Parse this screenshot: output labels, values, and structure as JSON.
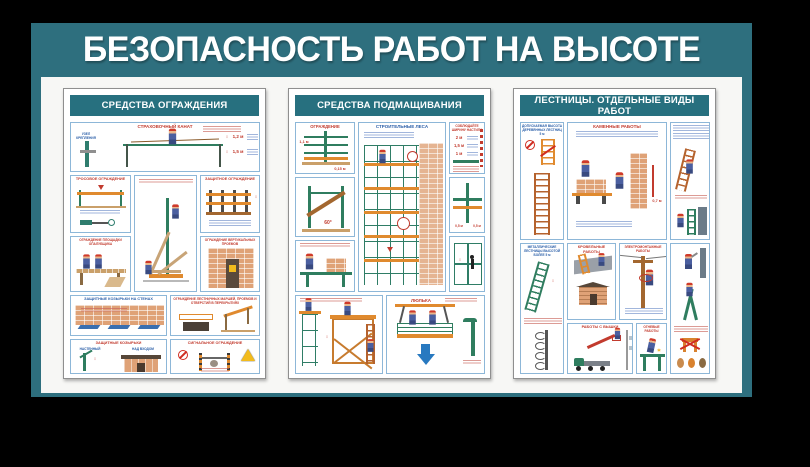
{
  "stand": {
    "title": "БЕЗОПАСНОСТЬ РАБОТ НА ВЫСОТЕ",
    "colors": {
      "background": "#000000",
      "stand_teal": "#2e6f7e",
      "header_teal": "#27707f",
      "board_bg": "#f7f7f5",
      "panel_border": "#8db7d8",
      "accent_red": "#c23b2e",
      "accent_blue": "#2b5fa8",
      "scaffold_green": "#2f7d5f",
      "deck_orange": "#e08a2e"
    }
  },
  "icons": {
    "v_arrow": "↕",
    "down_arrow": "▼",
    "spark": "✶"
  },
  "posters": [
    {
      "title": "СРЕДСТВА ОГРАЖДЕНИЯ",
      "panels": {
        "rope": {
          "title": "СТРАХОВОЧНЫЙ КАНАТ",
          "node": "УЗЕЛ КРЕПЛЕНИЯ",
          "dims": [
            "1,2 м",
            "1,5 м"
          ]
        },
        "cable": {
          "title": "ТРОСОВОЕ ОГРАЖДЕНИЕ"
        },
        "guard": {
          "title": "ЗАЩИТНОЕ ОГРАЖДЕНИЕ"
        },
        "platform": {
          "title": "ОГРАЖДЕНИЕ ПЛОЩАДКИ ОПАЛУБЩИКА"
        },
        "openings": {
          "title": "ОГРАЖДЕНИЕ ВЕРТИКАЛЬНЫХ ПРОЕМОВ"
        },
        "canopies_wall": {
          "title": "ЗАЩИТНЫЕ КОЗЫРЬКИ НА СТЕНАХ"
        },
        "stairs": {
          "title": "ОГРАЖДЕНИЕ ЛЕСТНИЧНЫХ МАРШЕЙ, ПРОЕМОВ И ОТВЕРСТИЙ В ПЕРЕКРЫТИЯХ"
        },
        "canopies": {
          "title": "ЗАЩИТНЫЕ КОЗЫРЬКИ",
          "wall": "НАСТЕННЫЙ",
          "entrance": "НАД ВХОДОМ"
        },
        "signal": {
          "title": "СИГНАЛЬНОЕ ОГРАЖДЕНИЕ"
        }
      }
    },
    {
      "title": "СРЕДСТВА ПОДМАЩИВАНИЯ",
      "panels": {
        "fence": {
          "title": "ОГРАЖДЕНИЕ",
          "dim1": "1,1 м",
          "dim2": "0,15 м"
        },
        "scaffold": {
          "title": "СТРОИТЕЛЬНЫЕ ЛЕСА"
        },
        "width": {
          "title": "СОБЛЮДАЙТЕ ШИРИНУ НАСТИЛА",
          "dims": [
            "2 м",
            "1,5 м",
            "1 м"
          ]
        },
        "brace": {
          "angle": "60°"
        },
        "anchor": {
          "dim_left": "0,5 м",
          "dim_right": "0,5 м"
        },
        "cradle": {
          "title": "ЛЮЛЬКА"
        }
      }
    },
    {
      "title": "ЛЕСТНИЦЫ. ОТДЕЛЬНЫЕ ВИДЫ РАБОТ",
      "panels": {
        "wooden": {
          "title": "ДОПУСКАЕМАЯ ВЫСОТА ДЕРЕВЯННЫХ ЛЕСТНИЦ 5 м"
        },
        "masonry": {
          "title": "КАМЕННЫЕ РАБОТЫ",
          "dim": "0,7 м"
        },
        "metal": {
          "title": "МЕТАЛЛИЧЕСКИЕ ЛЕСТНИЦЫ ВЫСОТОЙ БОЛЕЕ 5 м"
        },
        "roofing": {
          "title": "КРОВЕЛЬНЫЕ РАБОТЫ"
        },
        "electrical": {
          "title": "ЭЛЕКТРОМОНТАЖНЫЕ РАБОТЫ"
        },
        "boom": {
          "title": "РАБОТЫ С ВЫШКИ"
        },
        "hot": {
          "title": "ОГНЕВЫЕ РАБОТЫ"
        }
      }
    }
  ]
}
